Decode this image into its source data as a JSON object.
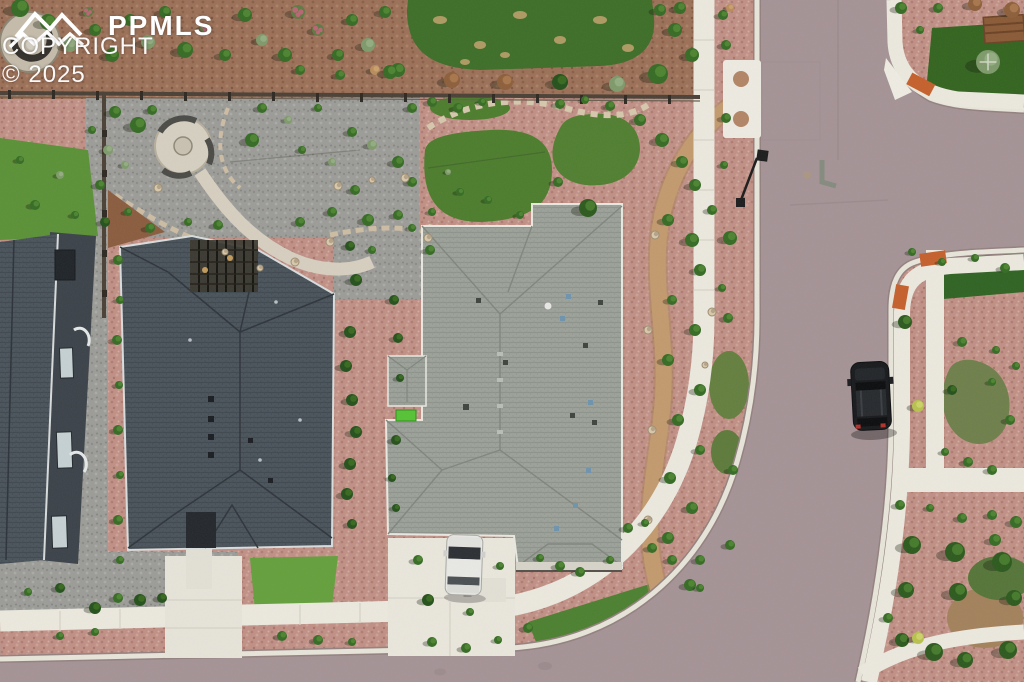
{
  "image": {
    "type": "aerial-drone-photograph",
    "scene": "Top-down view of a suburban residential neighborhood: two large gray-shingle-roofed homes with xeriscaped yards, a landscaped backyard with circular paver patio and oval lawns, a curving street with white curbs and sidewalks, a black SUV parked at the right curb and a white vehicle parked in the right home's driveway",
    "width_px": 1024,
    "height_px": 682
  },
  "watermark": {
    "brand": "PPMLS",
    "copyright": "COPYRIGHT © 2025",
    "logo": "mountain-range-icon",
    "text_color": "#ffffff"
  },
  "palette": {
    "asphalt_road": "#a59396",
    "sidewalk_concrete": "#ece9df",
    "curb_white": "#e8e5da",
    "red_rock_mulch": "#c09086",
    "brown_mulch": "#9b7058",
    "gray_gravel": "#9c9c98",
    "dark_shingle_roof": "#4a535b",
    "light_shingle_roof": "#9ca29a",
    "lawn_dark_green": "#3d6e28",
    "bright_grass": "#5a9136",
    "olive_grass": "#6e7f4b",
    "dirt_path": "#c39a6e",
    "ada_ramp_orange": "#c5602c",
    "suv_black": "#17191c",
    "vehicle_white": "#e8e8e6"
  },
  "landmarks": {
    "houses": [
      {
        "name": "left-home-partial",
        "roof": "dark charcoal shingles, east wall with windows visible"
      },
      {
        "name": "center-home",
        "roof": "dark charcoal hip roof with backyard pergola"
      },
      {
        "name": "right-home",
        "roof": "light gray hip roof with garage, driveway and entry porch"
      }
    ],
    "street": {
      "shape": "street running from top, T-intersection to the right edge, curving left along the bottom of the frame",
      "features": [
        "white curbs",
        "pedestrian ramps with orange tactile pads",
        "crosswalk dome pads",
        "street sign",
        "park bench at top-right corner"
      ]
    },
    "vehicles": [
      {
        "name": "black-suv",
        "position": "parked along right curb"
      },
      {
        "name": "white-pickup",
        "position": "parked in right home driveway"
      }
    ],
    "yard_features": [
      "circular paver patio with curved benches",
      "flagstone path",
      "oval lawn",
      "stone-edged grass beds",
      "winding dirt trail",
      "split-rail fence",
      "red rock mulch beds",
      "shrub and tree rows",
      "kidney-shaped grass patches"
    ]
  }
}
